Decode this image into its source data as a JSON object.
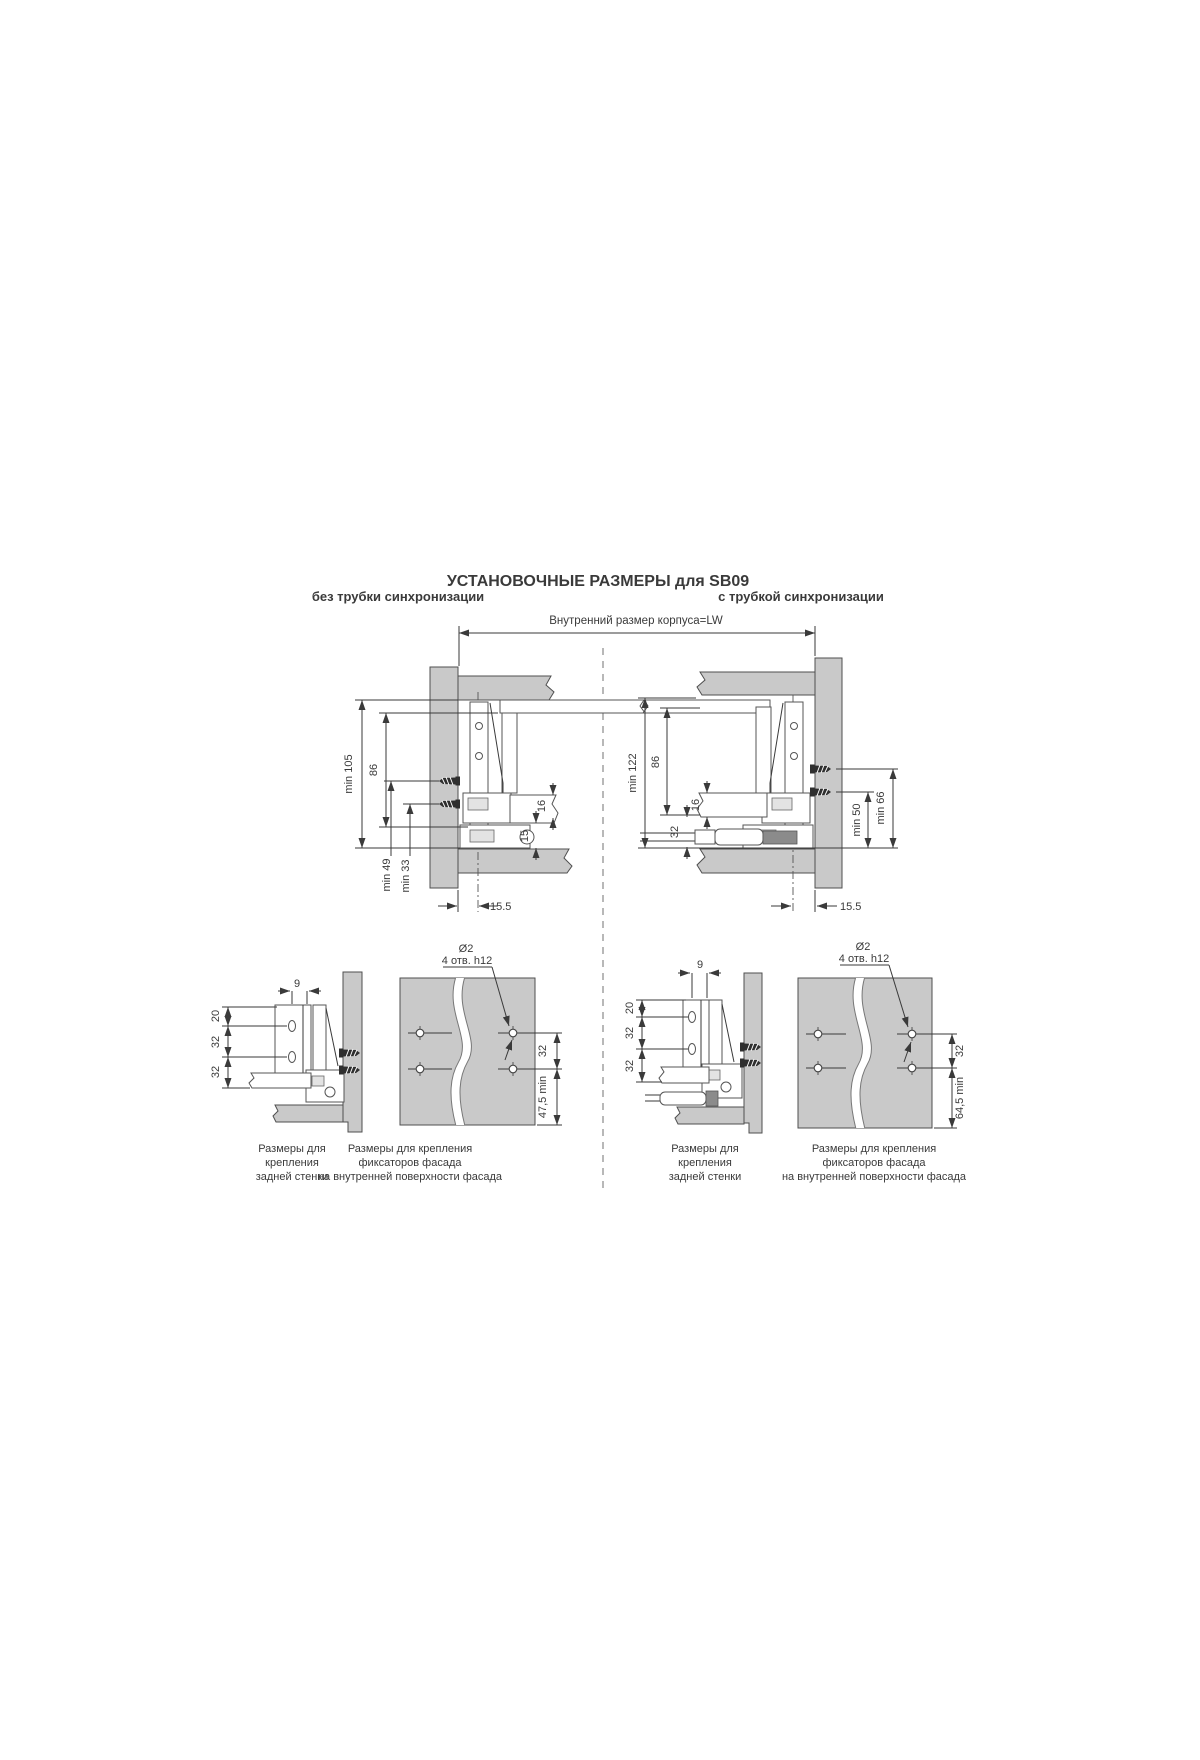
{
  "title": "УСТАНОВОЧНЫЕ РАЗМЕРЫ для SB09",
  "colors": {
    "panel_gray": "#c9c9c9",
    "line": "#3a3a3a"
  },
  "top": {
    "lw_label": "Внутренний размер корпуса=LW",
    "left": {
      "subtitle": "без трубки синхронизации",
      "dims": {
        "total": "min 105",
        "rail": "86",
        "screw_top": "min 49",
        "screw_bottom": "min 33",
        "bottom_thk": "16",
        "clearance": "15",
        "front_gap": "15.5"
      }
    },
    "right": {
      "subtitle": "с трубкой синхронизации",
      "dims": {
        "total": "min 122",
        "rail": "86",
        "bottom_thk": "16",
        "tube": "32",
        "screw_bottom": "min 50",
        "screw_top": "min 66",
        "front_gap": "15.5"
      }
    }
  },
  "bottom": {
    "rear_left": {
      "dims": {
        "offset": "9",
        "r1": "20",
        "r2": "32",
        "r3": "32"
      },
      "caption": [
        "Размеры для",
        "крепления",
        "задней стенки"
      ]
    },
    "facade_left": {
      "dia": "Ø2",
      "spec": "4 отв. h12",
      "dims": {
        "spacing": "32",
        "edge": "47,5 min"
      },
      "caption": [
        "Размеры для крепления",
        "фиксаторов фасада",
        "на внутренней поверхности фасада"
      ]
    },
    "rear_right": {
      "dims": {
        "offset": "9",
        "r1": "20",
        "r2": "32",
        "r3": "32"
      },
      "caption": [
        "Размеры для",
        "крепления",
        "задней стенки"
      ]
    },
    "facade_right": {
      "dia": "Ø2",
      "spec": "4 отв. h12",
      "dims": {
        "spacing": "32",
        "edge": "64,5 min"
      },
      "caption": [
        "Размеры для крепления",
        "фиксаторов фасада",
        "на внутренней поверхности фасада"
      ]
    }
  }
}
